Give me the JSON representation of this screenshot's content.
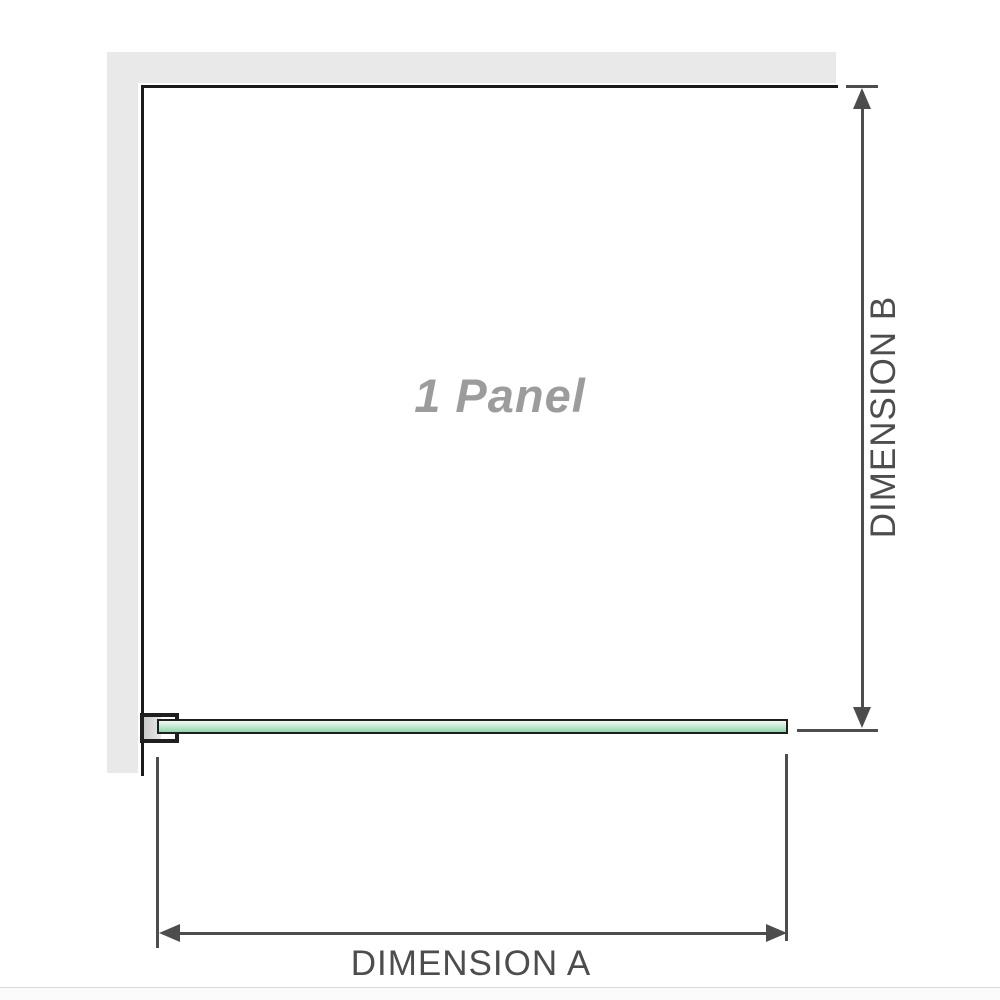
{
  "diagram": {
    "panel_label": "1 Panel",
    "dimensions": {
      "a_label": "DIMENSION A",
      "b_label": "DIMENSION B"
    }
  },
  "colors": {
    "wall": "#e9e9e9",
    "wall_line": "#1b1b1b",
    "dimension": "#4d4d4d",
    "panel_label": "#9c9c9c",
    "glass_border": "#1f1f1f",
    "divider": "#d9d9d9"
  }
}
